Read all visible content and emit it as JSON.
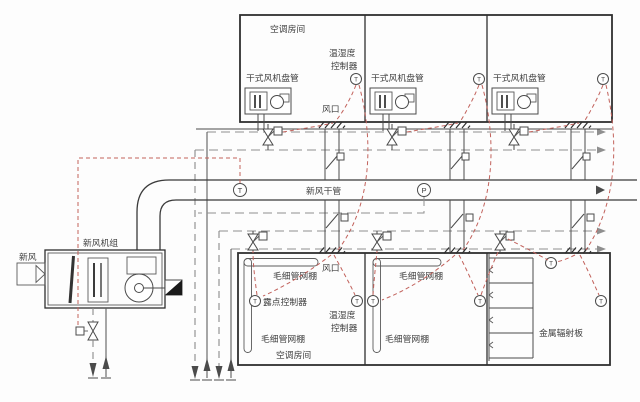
{
  "upper": {
    "room_label": "空调房间",
    "controller_line1": "温湿度",
    "controller_line2": "控制器",
    "fcu_label": "干式风机盘管",
    "vent_label": "风口"
  },
  "duct": {
    "label": "新风干管",
    "t_sensor": "T",
    "p_sensor": "P"
  },
  "ahu": {
    "label": "新风机组",
    "fresh_air": "新风"
  },
  "lower": {
    "capillary_label": "毛细管网棚",
    "dew_label": "露点控制器",
    "controller_line1": "温湿度",
    "controller_line2": "控制器",
    "room_label": "空调房间",
    "vent_label": "风口",
    "radiant_label": "金属辐射板"
  },
  "sensors": {
    "t": "T"
  },
  "colors": {
    "line": "#4b4b4b",
    "red_control": "#c2625c",
    "pipe_chain": "#909090",
    "wall": "#2f2f2f"
  }
}
